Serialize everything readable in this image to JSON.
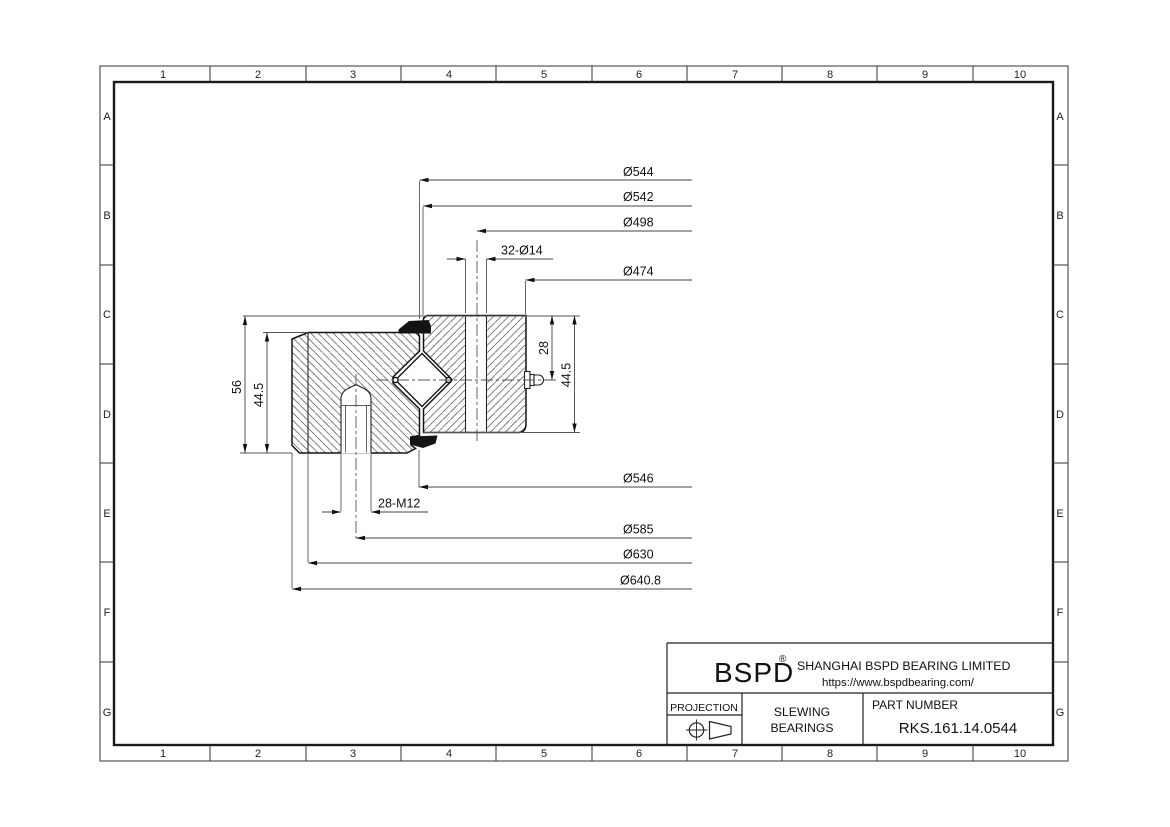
{
  "frame": {
    "columns": [
      "1",
      "2",
      "3",
      "4",
      "5",
      "6",
      "7",
      "8",
      "9",
      "10"
    ],
    "rows": [
      "A",
      "B",
      "C",
      "D",
      "E",
      "F",
      "G"
    ]
  },
  "dimensions": {
    "top": [
      "Ø544",
      "Ø542",
      "Ø498",
      "Ø474"
    ],
    "top_holes": "32-Ø14",
    "bottom": [
      "Ø546",
      "Ø585",
      "Ø630",
      "Ø640.8"
    ],
    "bottom_holes": "28-M12",
    "left": [
      "56",
      "44.5"
    ],
    "right": [
      "28",
      "44.5"
    ]
  },
  "title_block": {
    "brand": "BSPD",
    "brand_mark": "®",
    "company": "SHANGHAI BSPD BEARING LIMITED",
    "website": "https://www.bspdbearing.com/",
    "projection_label": "PROJECTION",
    "projection_symbol": "first-angle-projection-icon",
    "product_line1": "SLEWING",
    "product_line2": "BEARINGS",
    "part_number_label": "PART NUMBER",
    "part_number": "RKS.161.14.0544"
  }
}
